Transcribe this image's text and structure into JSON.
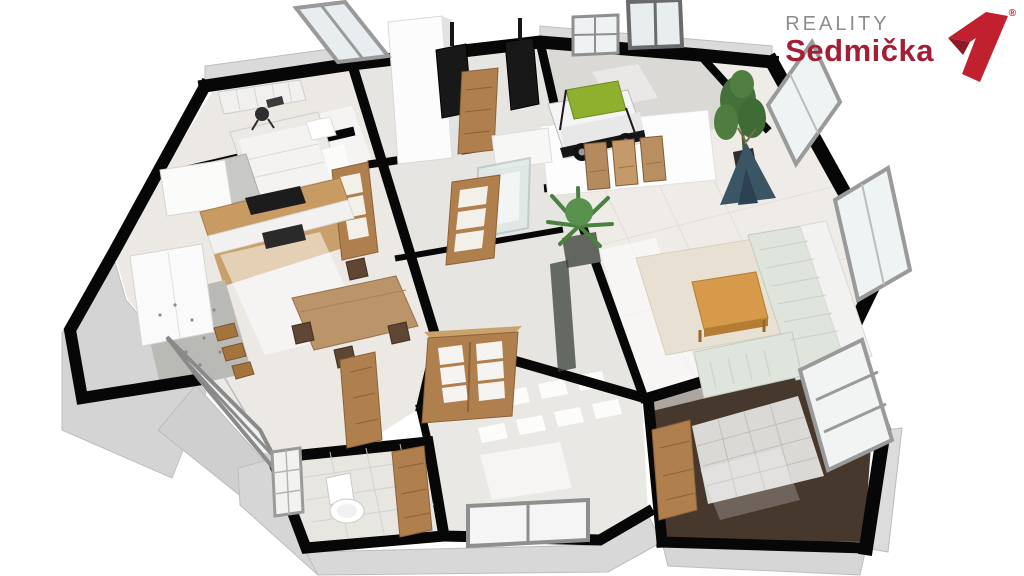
{
  "brand": {
    "line1": "REALITY",
    "line2": "Sedmička",
    "registered": "®",
    "line1_color": "#8d8d8d",
    "line2_color": "#a31f35",
    "seven_bright": "#c1202e",
    "seven_dark": "#8c1b29"
  },
  "scene": {
    "type": "3d-floor-plan-render",
    "background": "#ffffff",
    "wall_top_color": "#070707",
    "exterior_plinth_color": "#d4d4d4",
    "floor_light": "#ece9e4",
    "floor_dark_tile": "#47382d",
    "wood_door": "#b07f4e",
    "counter_wood": "#c89b62",
    "sofa_color": "#dfe5dd",
    "rug_color": "#e8e0d2",
    "plant_green": "#4a8040",
    "teepee_blue": "#3b5565",
    "car_bed_canopy_green": "#8faf2e",
    "rooms": [
      "bedroom",
      "kitchen-dining",
      "technical-room",
      "bathroom",
      "kids-room",
      "living-room",
      "hallway",
      "wc",
      "storage-room"
    ],
    "furniture": [
      "bed",
      "wardrobe",
      "desk-chair",
      "armchair",
      "kitchen-counter",
      "cooktop",
      "fridge",
      "dining-table",
      "dining-chairs",
      "glazed-patio-door",
      "interior-doors",
      "boilers",
      "shower",
      "car-bed",
      "teepee-tent",
      "triptych-painting",
      "potted-plants",
      "rug",
      "coffee-table",
      "sectional-sofa",
      "toilet",
      "windows"
    ]
  }
}
